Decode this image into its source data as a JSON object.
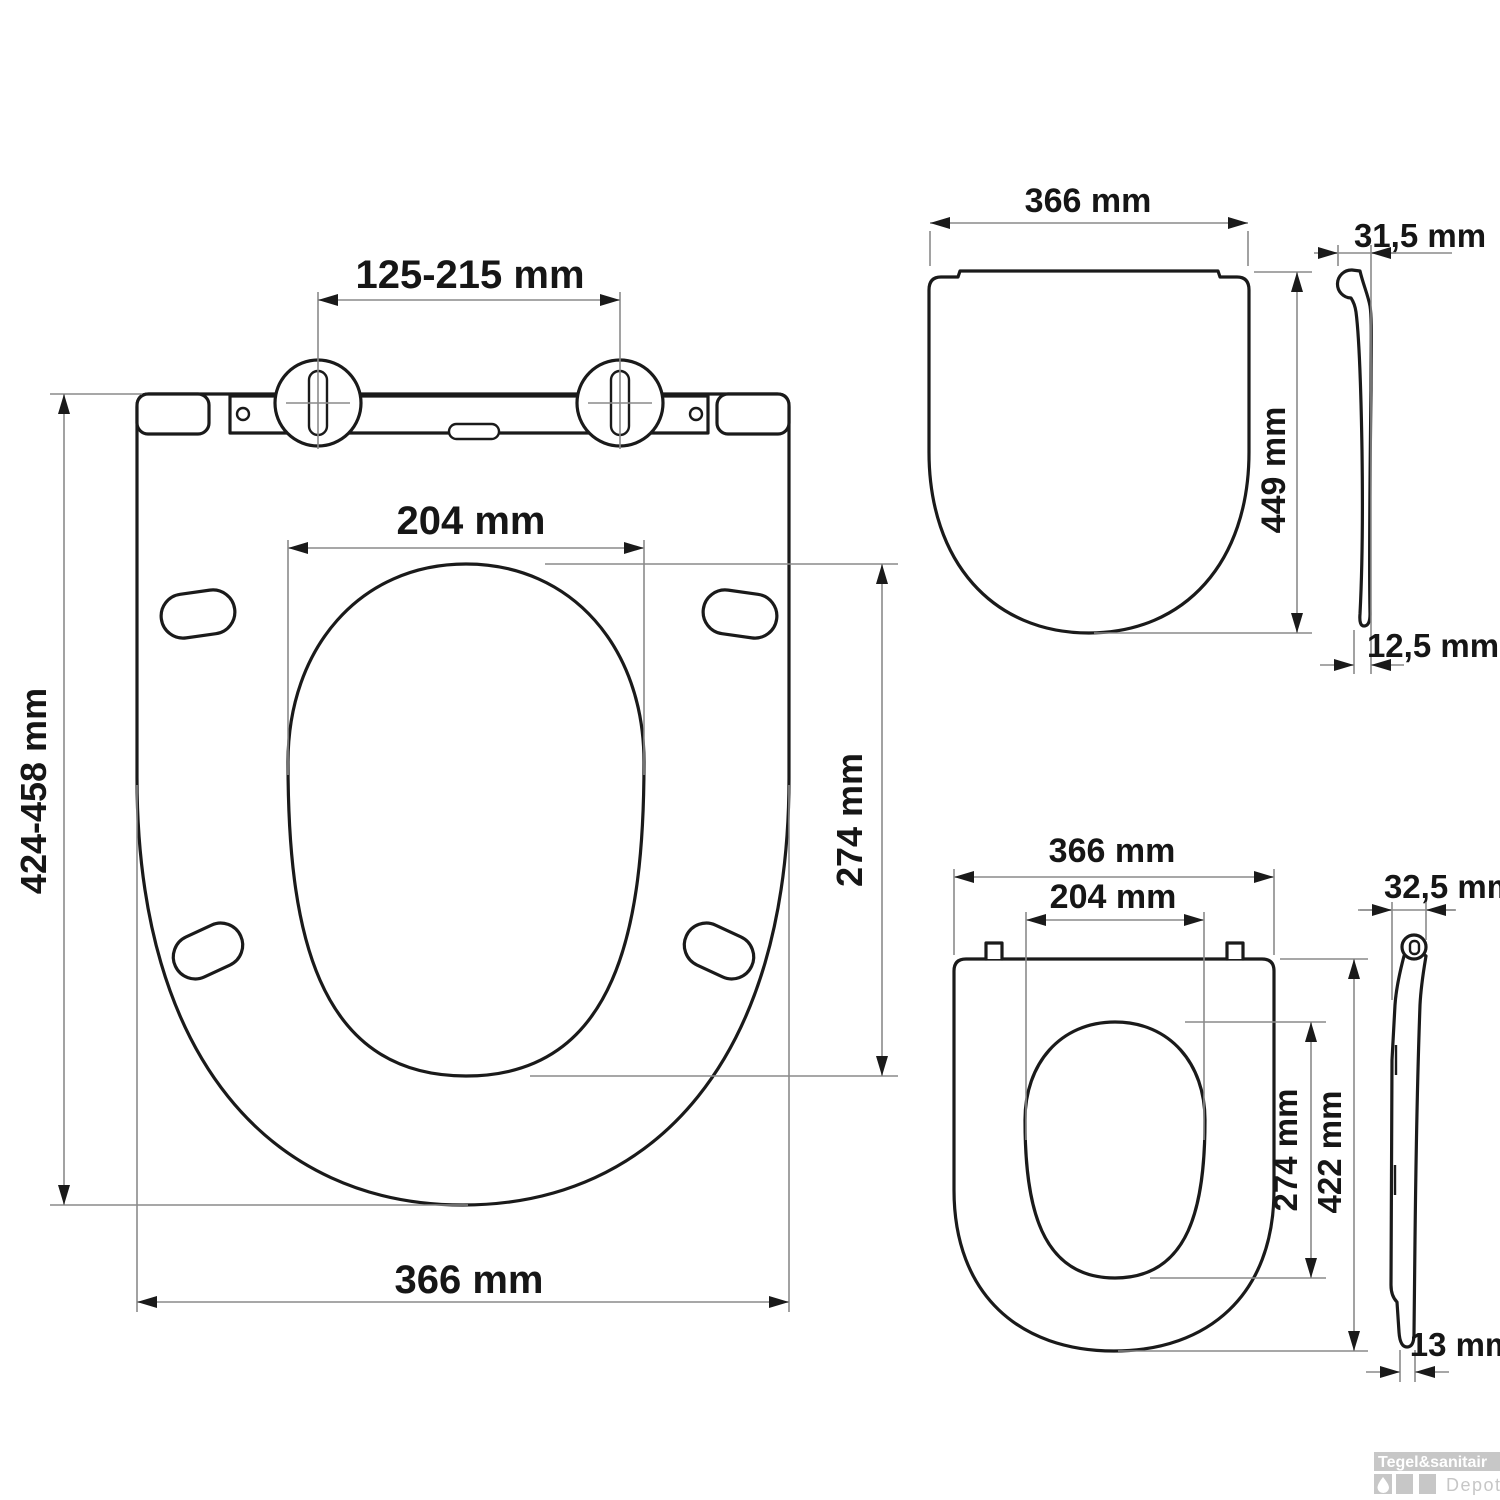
{
  "colors": {
    "line": "#1a1a1a",
    "dimension_line": "#8a8a8a",
    "background": "#ffffff",
    "watermark": "#c7c7c7"
  },
  "views": {
    "seat_open_top": {
      "label": "seat with lid open, top view",
      "dims": {
        "hinge_hole_spacing": "125-215 mm",
        "opening_width": "204 mm",
        "opening_depth": "274 mm",
        "length_range": "424-458 mm",
        "outer_width": "366 mm"
      }
    },
    "lid_closed_top": {
      "label": "closed lid, top view",
      "dims": {
        "outer_width": "366 mm",
        "length": "449 mm"
      }
    },
    "lid_side": {
      "label": "lid, side profile",
      "dims": {
        "hinge_height": "31,5 mm",
        "front_thickness": "12,5 mm"
      }
    },
    "seat_ring_top": {
      "label": "seat ring, top view",
      "dims": {
        "outer_width": "366 mm",
        "opening_width": "204 mm",
        "opening_depth": "274 mm",
        "length": "422 mm"
      }
    },
    "seat_ring_side": {
      "label": "seat ring, side profile",
      "dims": {
        "hinge_height": "32,5 mm",
        "front_thickness": "13 mm"
      }
    }
  },
  "watermark": {
    "brand": "Tegel&sanitair",
    "sub_brand": "Depot"
  }
}
